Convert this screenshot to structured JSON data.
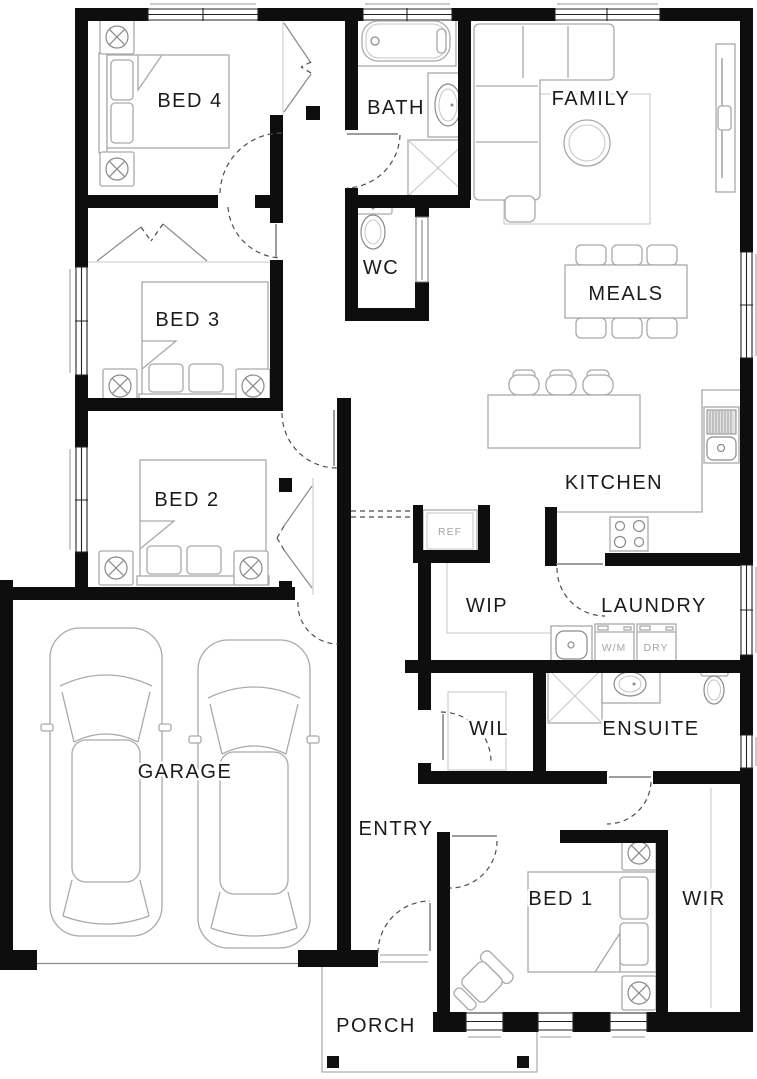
{
  "rooms": {
    "bed4": "BED 4",
    "bath": "BATH",
    "family": "FAMILY",
    "wc": "WC",
    "bed3": "BED 3",
    "meals": "MEALS",
    "kitchen": "KITCHEN",
    "bed2": "BED 2",
    "wip": "WIP",
    "laundry": "LAUNDRY",
    "garage": "GARAGE",
    "wil": "WIL",
    "ensuite": "ENSUITE",
    "entry": "ENTRY",
    "bed1": "BED 1",
    "wir": "WIR",
    "porch": "PORCH"
  },
  "appliances": {
    "fridge": "REF",
    "washer": "W/M",
    "dryer": "DRY"
  },
  "colors": {
    "background": "#ffffff",
    "wall": "#0e0e0e",
    "furniture_line": "#a9a9a9",
    "room_label": "#1b1b1b",
    "appliance_label": "#a6a6a6",
    "door_swing": "#4d4d4d"
  }
}
